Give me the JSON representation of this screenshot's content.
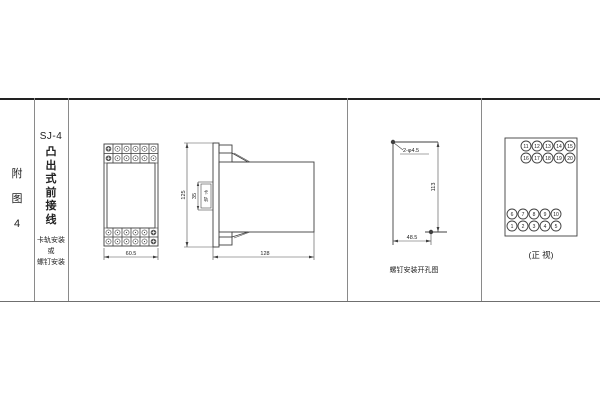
{
  "figure": {
    "index_label": [
      "附",
      "图",
      "4"
    ],
    "model": "SJ-4",
    "type_label": [
      "凸",
      "出",
      "式",
      "前",
      "接",
      "线"
    ],
    "mount_label": [
      "卡轨安装",
      "或",
      "螺钉安装"
    ]
  },
  "front_view": {
    "width_dim": "60.5",
    "terminal_grid": {
      "rows": 2,
      "cols": 6
    }
  },
  "side_view": {
    "height_dim": "125",
    "rail_dim": "35",
    "rail_label_chars": [
      "卡",
      "轨"
    ],
    "depth_dim": "128"
  },
  "drill_view": {
    "hole_label": "2-φ4.5",
    "height_dim": "113",
    "width_dim": "48.5",
    "caption": "螺钉安装开孔图"
  },
  "terminal_view": {
    "groups": [
      {
        "align": "right",
        "rows": [
          [
            "11",
            "12",
            "13",
            "14",
            "15"
          ],
          [
            "16",
            "17",
            "18",
            "19",
            "20"
          ]
        ]
      },
      {
        "align": "left",
        "rows": [
          [
            "6",
            "7",
            "8",
            "9",
            "10"
          ],
          [
            "1",
            "2",
            "3",
            "4",
            "5"
          ]
        ]
      }
    ],
    "caption": "(正 视)"
  },
  "colors": {
    "background": "#ffffff",
    "drawing_line": "#3f3f3f",
    "table_line": "#8a8a8a"
  }
}
